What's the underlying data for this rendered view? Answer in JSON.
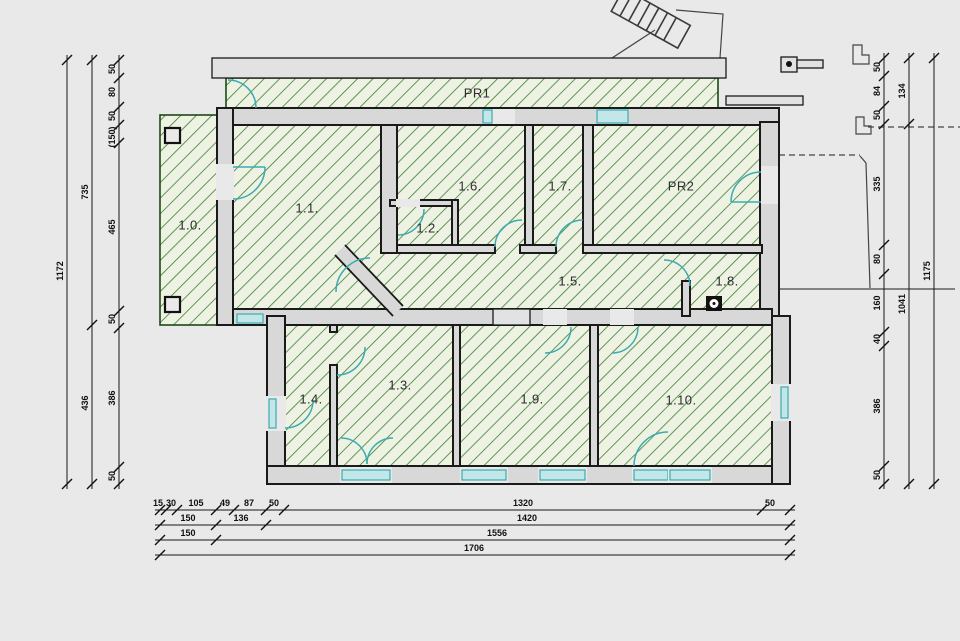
{
  "title": "Floor plan with dimensions",
  "rooms": {
    "pr1": "PR1",
    "pr2": "PR2",
    "r0": "1.0.",
    "r1": "1.1.",
    "r2": "1.2.",
    "r3": "1.3.",
    "r4": "1.4.",
    "r5": "1.5.",
    "r6": "1.6.",
    "r7": "1.7.",
    "r8": "1.8.",
    "r9": "1.9.",
    "r10": "1.10."
  },
  "dims": {
    "left": {
      "total": "1172",
      "upper": "735",
      "lower": "436",
      "chain": [
        "50",
        "80",
        "50",
        "(150)",
        "465",
        "50",
        "386",
        "50"
      ]
    },
    "right": {
      "chain": [
        "50",
        "84",
        "50",
        "335",
        "80",
        "160",
        "40",
        "386",
        "50"
      ],
      "inner": [
        "134",
        "1041"
      ],
      "total": "1175"
    },
    "bottom": {
      "row1": [
        "15",
        "30",
        "105",
        "49",
        "87",
        "50",
        "1320",
        "50"
      ],
      "row2": [
        "150",
        "136",
        "1420"
      ],
      "row3": [
        "150",
        "1556"
      ],
      "row4": [
        "1706"
      ]
    }
  },
  "colors": {
    "background": "#e9e9e9",
    "wall_fill": "#d8d8d8",
    "line": "#1a1a1a",
    "hatch": "#3f7d32",
    "hatch_bg": "#edf2e3",
    "opening": "#3aacb1"
  }
}
